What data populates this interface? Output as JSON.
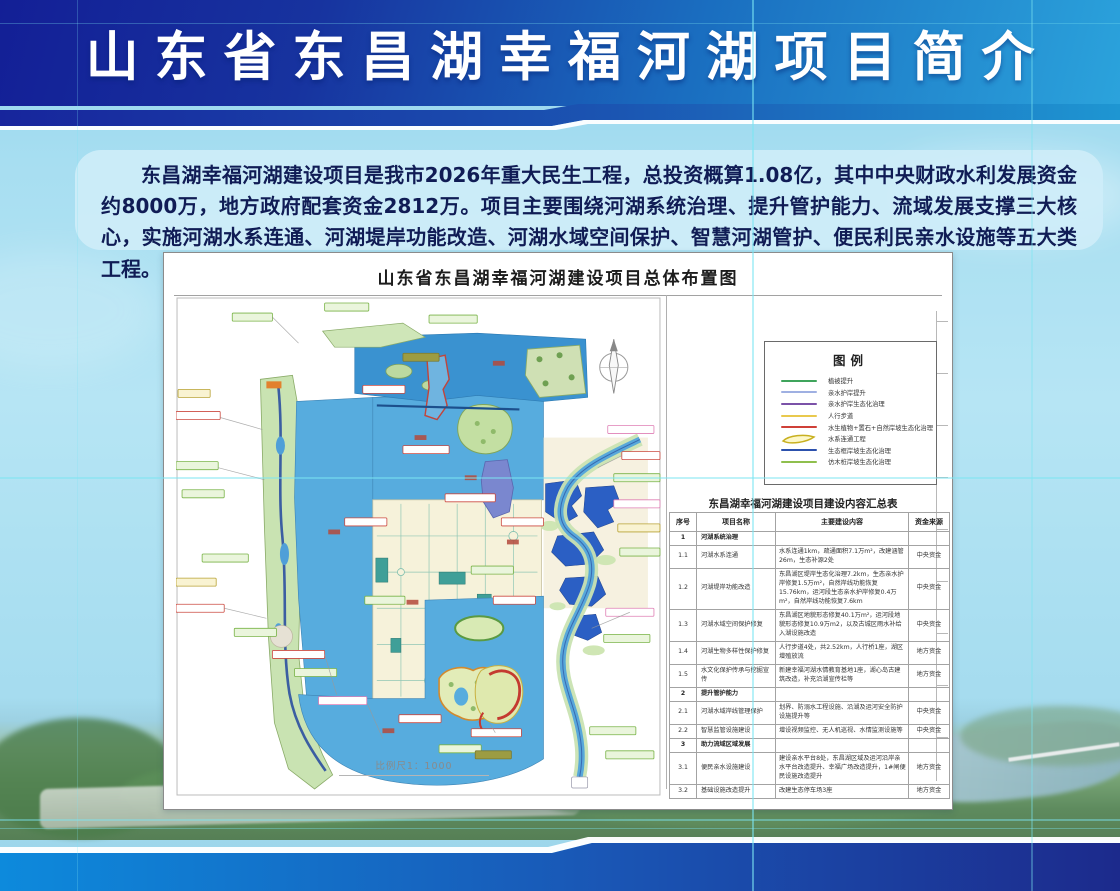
{
  "banner": {
    "title": "山东省东昌湖幸福河湖项目简介"
  },
  "intro": {
    "text": "东昌湖幸福河湖建设项目是我市2026年重大民生工程，总投资概算1.08亿，其中中央财政水利发展资金约8000万，地方政府配套资金2812万。项目主要围绕河湖系统治理、提升管护能力、流域发展支撑三大核心，实施河湖水系连通、河湖堤岸功能改造、河湖水域空间保护、智慧河湖管护、便民利民亲水设施等五大类工程。"
  },
  "map_panel": {
    "title": "山东省东昌湖幸福河湖建设项目总体布置图",
    "scale_label": "比例尺1：1000",
    "legend": {
      "title": "图例",
      "items": [
        {
          "label": "植被提升",
          "color": "#3fa45c",
          "type": "line"
        },
        {
          "label": "亲水护岸提升",
          "color": "#9fb0e2",
          "type": "line"
        },
        {
          "label": "亲水护岸生态化治理",
          "color": "#7b52a8",
          "type": "line"
        },
        {
          "label": "人行步道",
          "color": "#e9c94e",
          "type": "line"
        },
        {
          "label": "水生植物+置石+自然岸坡生态化治理",
          "color": "#cf4038",
          "type": "line"
        },
        {
          "label": "水系连通工程",
          "color": "#c8b020",
          "type": "shape"
        },
        {
          "label": "生态框岸坡生态化治理",
          "color": "#2c51ad",
          "type": "line"
        },
        {
          "label": "仿木桩岸坡生态化治理",
          "color": "#8fbf4d",
          "type": "line"
        }
      ]
    },
    "table": {
      "title": "东昌湖幸福河湖建设项目建设内容汇总表",
      "headers": [
        "序号",
        "项目名称",
        "主要建设内容",
        "资金来源"
      ],
      "rows": [
        {
          "no": "1",
          "name": "河湖系统治理",
          "content": "",
          "fund": "",
          "section": true
        },
        {
          "no": "1.1",
          "name": "河湖水系连通",
          "content": "水系连通1km，疏通面积7.1万m²，改建涵管26m，生态补源2处",
          "fund": "中央资金"
        },
        {
          "no": "1.2",
          "name": "河湖堤岸功能改造",
          "content": "东昌湖区堤岸生态化治理7.2km，生态亲水护岸修复1.5万m²，自然岸线功能恢复15.76km，运河段生态亲水护岸修复0.4万m²，自然岸线功能恢复7.6km",
          "fund": "中央资金"
        },
        {
          "no": "1.3",
          "name": "河湖水域空间保护修复",
          "content": "东昌湖区地貌形态修复40.1万m²，运河段地貌形态修复10.9万m2，以及古城区雨水补给入湖设施改造",
          "fund": "中央资金"
        },
        {
          "no": "1.4",
          "name": "河湖生物多样性保护修复",
          "content": "人行步道4处，共2.52km，人行桥1座，湖区增殖放流",
          "fund": "地方资金"
        },
        {
          "no": "1.5",
          "name": "水文化保护传承与挖掘宣传",
          "content": "新建幸福河湖水情教育基地1座，湖心岛古建筑改造，补充沿湖宣传栏等",
          "fund": "地方资金"
        },
        {
          "no": "2",
          "name": "提升管护能力",
          "content": "",
          "fund": "",
          "section": true
        },
        {
          "no": "2.1",
          "name": "河湖水域岸线管理保护",
          "content": "划界、防溺水工程设施、沿湖及运河安全防护设施提升等",
          "fund": "中央资金"
        },
        {
          "no": "2.2",
          "name": "智慧监管设施建设",
          "content": "增设视频监控、无人机巡视、水情监测设施等",
          "fund": "中央资金"
        },
        {
          "no": "3",
          "name": "助力流域区域发展",
          "content": "",
          "fund": "",
          "section": true
        },
        {
          "no": "3.1",
          "name": "便民亲水设施建设",
          "content": "建设亲水平台8处，东昌湖区域及运河沿岸亲水平台改造提升、幸福广场改造提升，1#闸便民设施改造提升",
          "fund": "地方资金"
        },
        {
          "no": "3.2",
          "name": "基础设施改造提升",
          "content": "改建生态停车场3座",
          "fund": "地方资金"
        }
      ]
    }
  },
  "colors": {
    "banner_left": "#131f96",
    "banner_right": "#2ba3dc",
    "intro_bg": "#cdecf8",
    "intro_text": "#101c55",
    "lake_water": "#57acde",
    "deep_pond": "#2b5fc4",
    "registration_line": "#7ce5f2",
    "fund_central": "中央资金",
    "fund_local": "地方资金"
  }
}
